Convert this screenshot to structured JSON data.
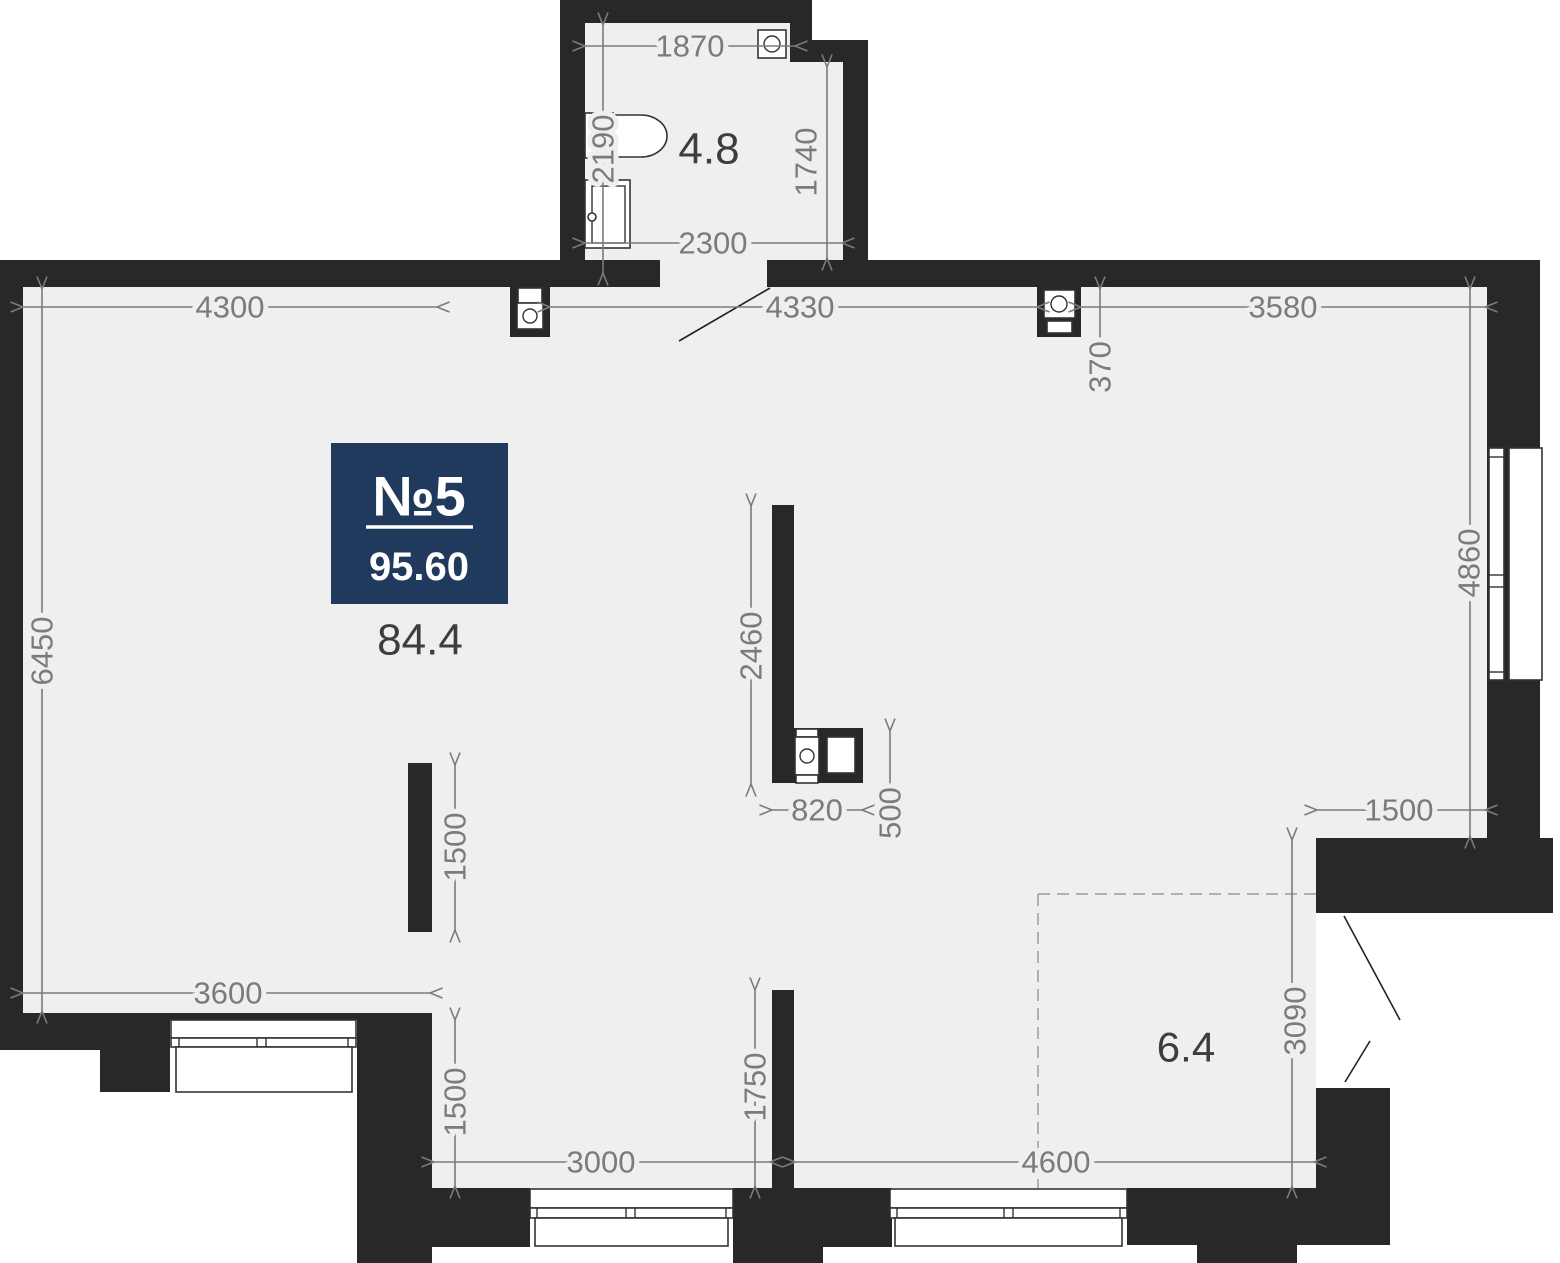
{
  "unit": {
    "number": "№5",
    "total_area": "95.60"
  },
  "areas": {
    "main_room": "84.4",
    "bathroom": "4.8",
    "balcony": "6.4"
  },
  "dims": {
    "bath_top_width": "1870",
    "bath_left_height": "2190",
    "bath_right_height": "1740",
    "bath_bottom_width": "2300",
    "top_left": "4300",
    "top_middle": "4330",
    "top_right": "3580",
    "vent_depth": "370",
    "left_height": "6450",
    "right_window_height": "4860",
    "kitchen_wall_height": "2460",
    "kitchen_wall_width": "820",
    "kitchen_gap": "500",
    "closet_wall": "1500",
    "bottom_left_width": "3600",
    "recess_height": "1500",
    "stub_height": "1750",
    "bottom_middle_width": "3000",
    "bottom_right_width": "4600",
    "balcony_height": "3090",
    "right_offset": "1500"
  },
  "colors": {
    "wall": "#282828",
    "floor": "#efefef",
    "dimension": "#7b7b7b",
    "badge": "#1f3a5c"
  }
}
